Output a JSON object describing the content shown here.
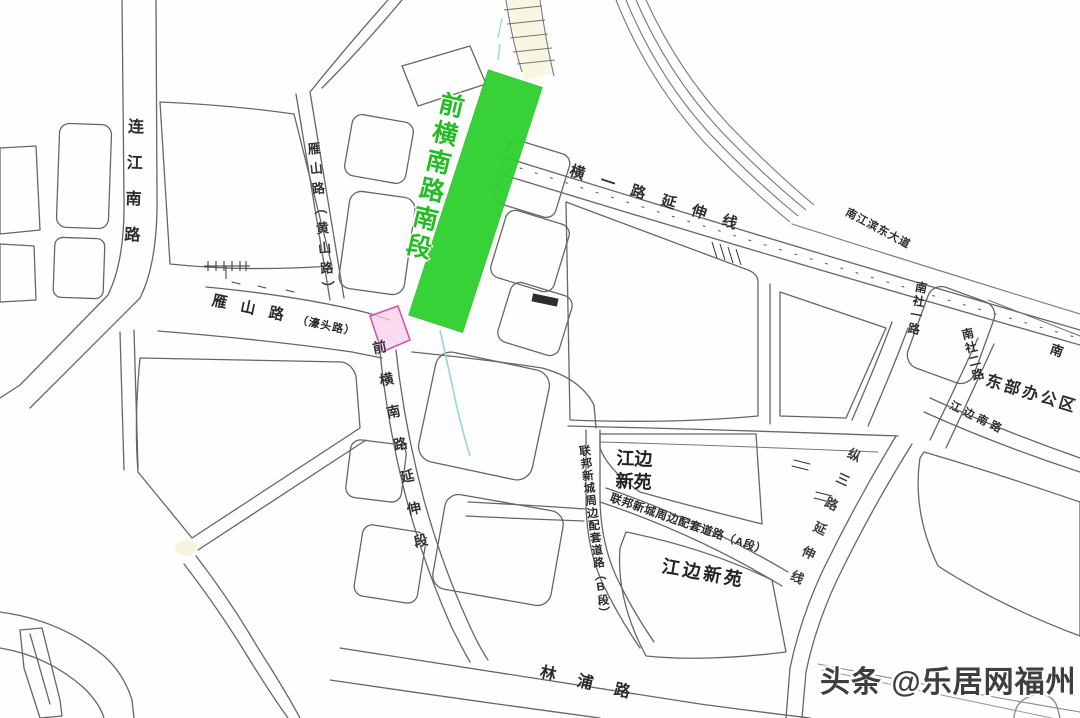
{
  "map": {
    "highlight": {
      "label": "前横南路南段",
      "color": "#2fd12f",
      "intersection_box_color": "#cf4fae"
    },
    "roads": {
      "lianjiang_south": "连江南路",
      "yanshan_vertical": "雁山路（黄山路）",
      "yanshan_main": "雁山路",
      "yanshan_paren": "（濠头路）",
      "hengyi_ext": "横一路延伸线",
      "nanjiangbin_east": "南江滨东大道",
      "nanshe_1": "南社一路",
      "nanshe_2": "南社二路",
      "nan_partial": "南",
      "dongbu_office": "东部办公区",
      "jiangbian_south": "江边南路",
      "zongsan_ext": "纵三路延伸线",
      "jiangbian_xinyuan_block": "江边新苑",
      "lianbang_a": "联邦新城周边配套道路（A段）",
      "lianbang_b": "联邦新城周边配套道路（B段）",
      "jiangbian_xinyuan_south": "江边新苑",
      "qianheng_ext": "前横南路延伸段",
      "linpu": "林浦路"
    },
    "watermark": "头条 @乐居网福州"
  }
}
